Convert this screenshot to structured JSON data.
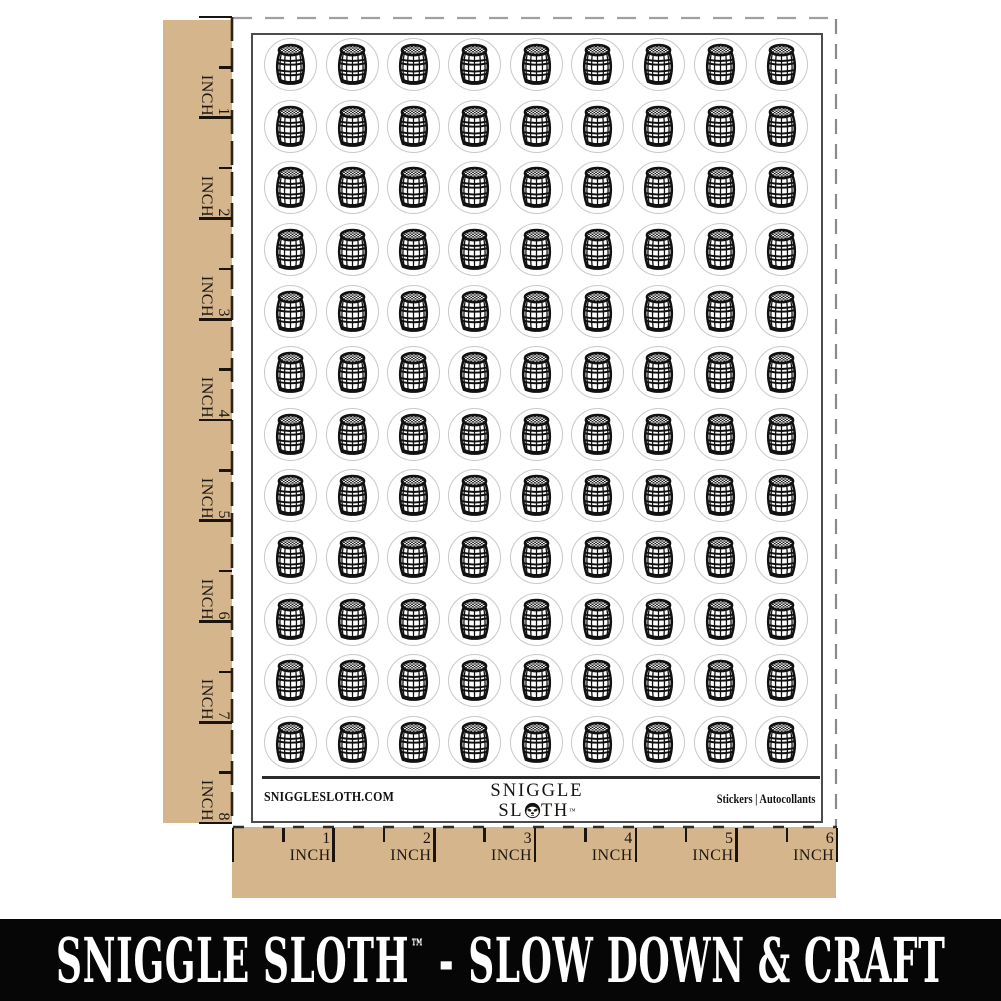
{
  "sheet": {
    "website": "SNIGGLESLOTH.COM",
    "product_label": "Stickers  |  Autocollants",
    "logo": {
      "line1": "SNIGGLE",
      "line2_pre": "SL",
      "line2_post": "TH",
      "trademark": "™"
    },
    "grid": {
      "rows": 12,
      "cols": 9,
      "icon": "wine-barrel",
      "sticker_count": 108
    }
  },
  "rulers": {
    "left": {
      "unit": "INCH",
      "marks": [
        "1",
        "2",
        "3",
        "4",
        "5",
        "6",
        "7",
        "8"
      ]
    },
    "bottom": {
      "unit": "INCH",
      "marks": [
        "1",
        "2",
        "3",
        "4",
        "5",
        "6"
      ]
    }
  },
  "banner": {
    "brand": "SNIGGLE SLOTH",
    "trademark": "™",
    "separator": "-",
    "tagline": "SLOW DOWN & CRAFT"
  },
  "colors": {
    "backing_kraft": "#d5b58c",
    "banner_background": "#060606",
    "banner_text": "#ffffff",
    "ink": "#111111",
    "sticker_cut_outline": "#c9c9c9",
    "sheet_border": "#4c4c4c"
  }
}
